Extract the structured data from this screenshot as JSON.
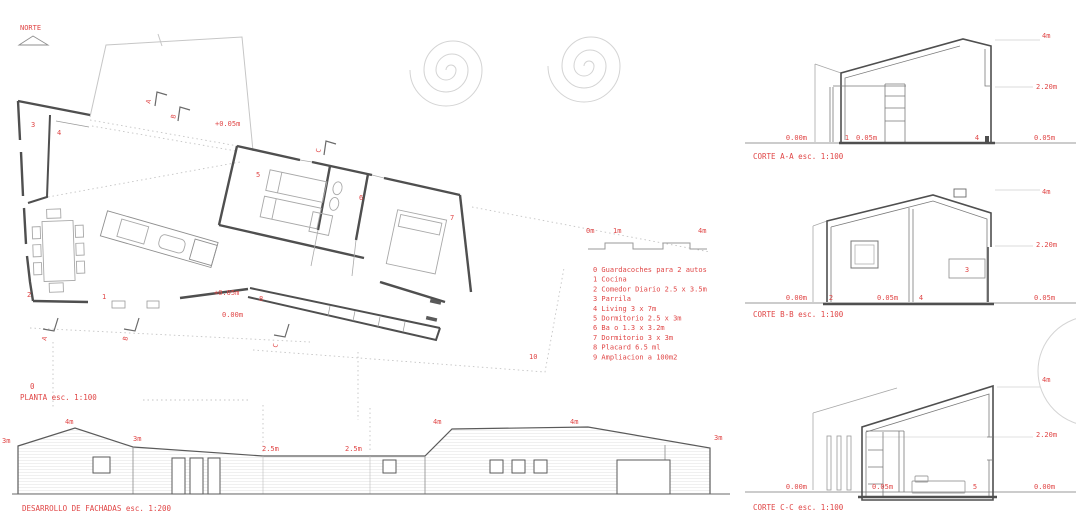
{
  "colors": {
    "red": "#e04646",
    "dark": "#4f4f4f",
    "mid": "#8a8a8a",
    "light": "#c8c8c8"
  },
  "north": {
    "label": "NORTE"
  },
  "plan": {
    "number": "0",
    "title": "PLANTA esc. 1:100",
    "labels": {
      "parrila": "3",
      "living": "4",
      "courtyard_level": "+0.05m",
      "dorm1": "5",
      "bath": "6",
      "dorm2": "7",
      "comedor": "2",
      "cocina": "1",
      "terrace_level": "+0.05m",
      "placard": "8",
      "ground_level": "0.00m",
      "ampliacion": "10"
    },
    "markers": {
      "a": "A",
      "b": "B",
      "c": "C"
    }
  },
  "scale_bar": {
    "ticks": [
      "0m",
      "1m",
      "4m"
    ]
  },
  "legend": {
    "items": [
      "0 Guardacoches para 2 autos",
      "1 Cocina",
      "2 Comedor Diario 2.5 x 3.5m",
      "3 Parrila",
      "4 Living 3 x 7m",
      "5 Dormitorio 2.5 x 3m",
      "6 Ba o 1.3 x 3.2m",
      "7 Dormitorio 3 x 3m",
      "8 Placard 6.5 ml",
      "9 Ampliacion a 100m2"
    ]
  },
  "sections": [
    {
      "title": "CORTE A-A esc. 1:100",
      "left_level": "0.00m",
      "num_left": "1",
      "mid_level": "0.05m",
      "num_right": "4",
      "right_level": "0.05m",
      "h_mid": "2.20m",
      "h_top": "4m"
    },
    {
      "title": "CORTE B-B esc. 1:100",
      "left_level": "0.00m",
      "num_left": "2",
      "mid_level": "0.05m",
      "num_right": "4",
      "box_num": "3",
      "right_level": "0.05m",
      "h_mid": "2.20m",
      "h_top": "4m"
    },
    {
      "title": "CORTE C-C esc. 1:100",
      "left_level": "0.00m",
      "mid_level": "0.05m",
      "num_right": "5",
      "right_level": "0.00m",
      "h_mid": "2.20m",
      "h_top": "4m"
    }
  ],
  "facades": {
    "title": "DESARROLLO DE FACHADAS esc. 1:200",
    "dims": [
      "3m",
      "4m",
      "3m",
      "2.5m",
      "2.5m",
      "4m",
      "4m",
      "3m"
    ]
  }
}
